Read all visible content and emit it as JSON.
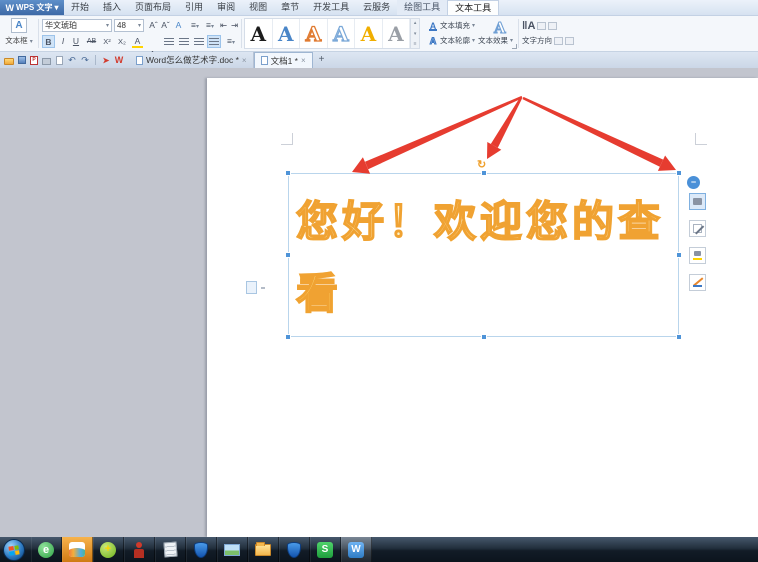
{
  "colors": {
    "accent_blue": "#4a90d8",
    "wordart_stroke": "#f0a232",
    "wordart_fill_top": "#fffdf2",
    "wordart_fill_bottom": "#ffd24d",
    "arrow_red": "#e63c30",
    "canvas_gray": "#c2c5ce",
    "taskbar_highlight_orange": "#e8912c"
  },
  "title_bar": {
    "logo_letter": "W",
    "app_name": "WPS 文字",
    "logo_dropdown": "▾"
  },
  "menu_tabs": [
    {
      "label": "开始"
    },
    {
      "label": "插入"
    },
    {
      "label": "页面布局"
    },
    {
      "label": "引用"
    },
    {
      "label": "审阅"
    },
    {
      "label": "视图"
    },
    {
      "label": "章节"
    },
    {
      "label": "开发工具"
    },
    {
      "label": "云服务"
    },
    {
      "label": "绘图工具"
    },
    {
      "label": "文本工具"
    }
  ],
  "ribbon": {
    "textbox_label": "文本框",
    "textbox_caret": "▾",
    "textbox_icon_letter": "A",
    "font_name": "华文琥珀",
    "font_size": "48",
    "grow_font": "A",
    "shrink_font": "A",
    "phonetic": "A",
    "bullets": "≡",
    "numbering": "≡",
    "indent_left": "⇤",
    "indent_right": "⇥",
    "char_scale": "A",
    "bold": "B",
    "italic": "I",
    "underline": "U",
    "strikethrough": "AB",
    "superscript": "X²",
    "subscript": "X₂",
    "highlight_letter": "A",
    "font_color_letter": "A",
    "line_spacing": "≡",
    "wordart_letters": [
      "A",
      "A",
      "A",
      "A",
      "A",
      "A"
    ],
    "gallery_up": "▴",
    "gallery_down": "▾",
    "gallery_more": "≡",
    "text_fill_label": "文本填充",
    "text_outline_label": "文本轮廓",
    "text_effects_label": "文本效果",
    "effects_preview_letter": "A",
    "fill_icon_letter": "A",
    "outline_icon_letter": "A",
    "direction_icon": "‖A",
    "text_direction_label": "文字方向",
    "caret": "▾"
  },
  "quick_access": {
    "undo_glyph": "↶",
    "redo_glyph": "↷",
    "red_flag_glyph": "➤",
    "wps_badge": "W",
    "pdf_badge": "P"
  },
  "tab_bar": {
    "documents": [
      {
        "title": "Word怎么做艺术字.doc *",
        "close_glyph": "×"
      },
      {
        "title": "文档1 *",
        "close_glyph": "×"
      }
    ],
    "new_tab_glyph": "+"
  },
  "document": {
    "wordart_text": "您好！欢迎您的查看",
    "wordart_lines": [
      "您好！欢迎您的查",
      "看"
    ],
    "rotate_handle_glyph": "↻"
  },
  "floating_toolbar": {
    "collapse_glyph": "−"
  },
  "taskbar": {
    "browser_letter": "e",
    "antivirus_plus": "+",
    "sogou_letter": "S",
    "wps_letter": "W"
  }
}
